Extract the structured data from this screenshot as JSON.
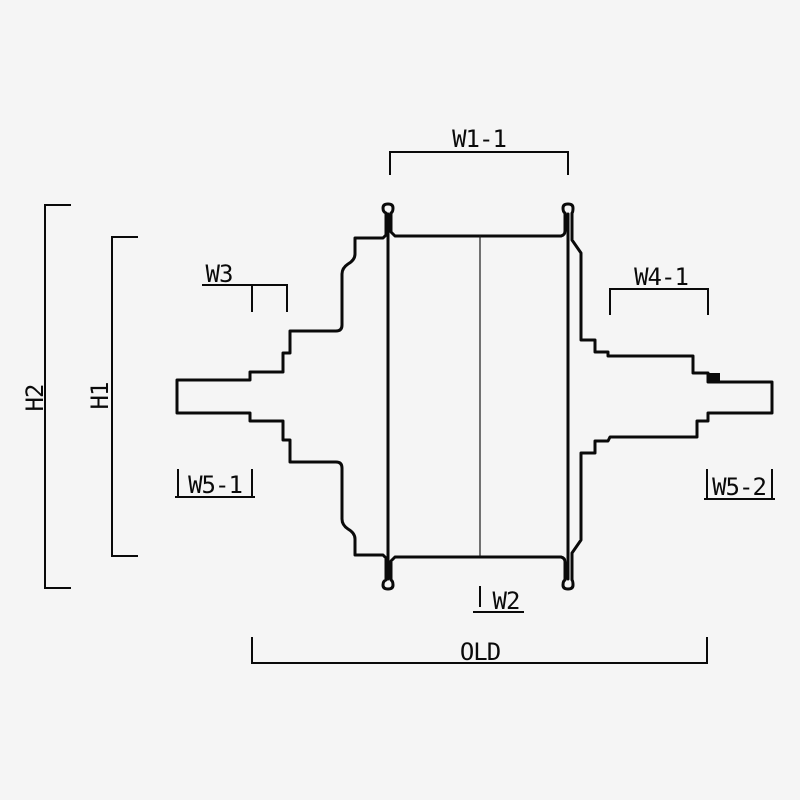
{
  "drawing": {
    "type": "technical-cross-section",
    "labels": {
      "w1_1": "W1-1",
      "h2": "H2",
      "h1": "H1",
      "w3": "W3",
      "w4_1": "W4-1",
      "w5_1": "W5-1",
      "w5_2": "W5-2",
      "w2": "W2",
      "old": "OLD"
    },
    "colors": {
      "background": "#f5f5f5",
      "line": "#0a0a0a",
      "centerline": "#1a1a1a"
    }
  }
}
